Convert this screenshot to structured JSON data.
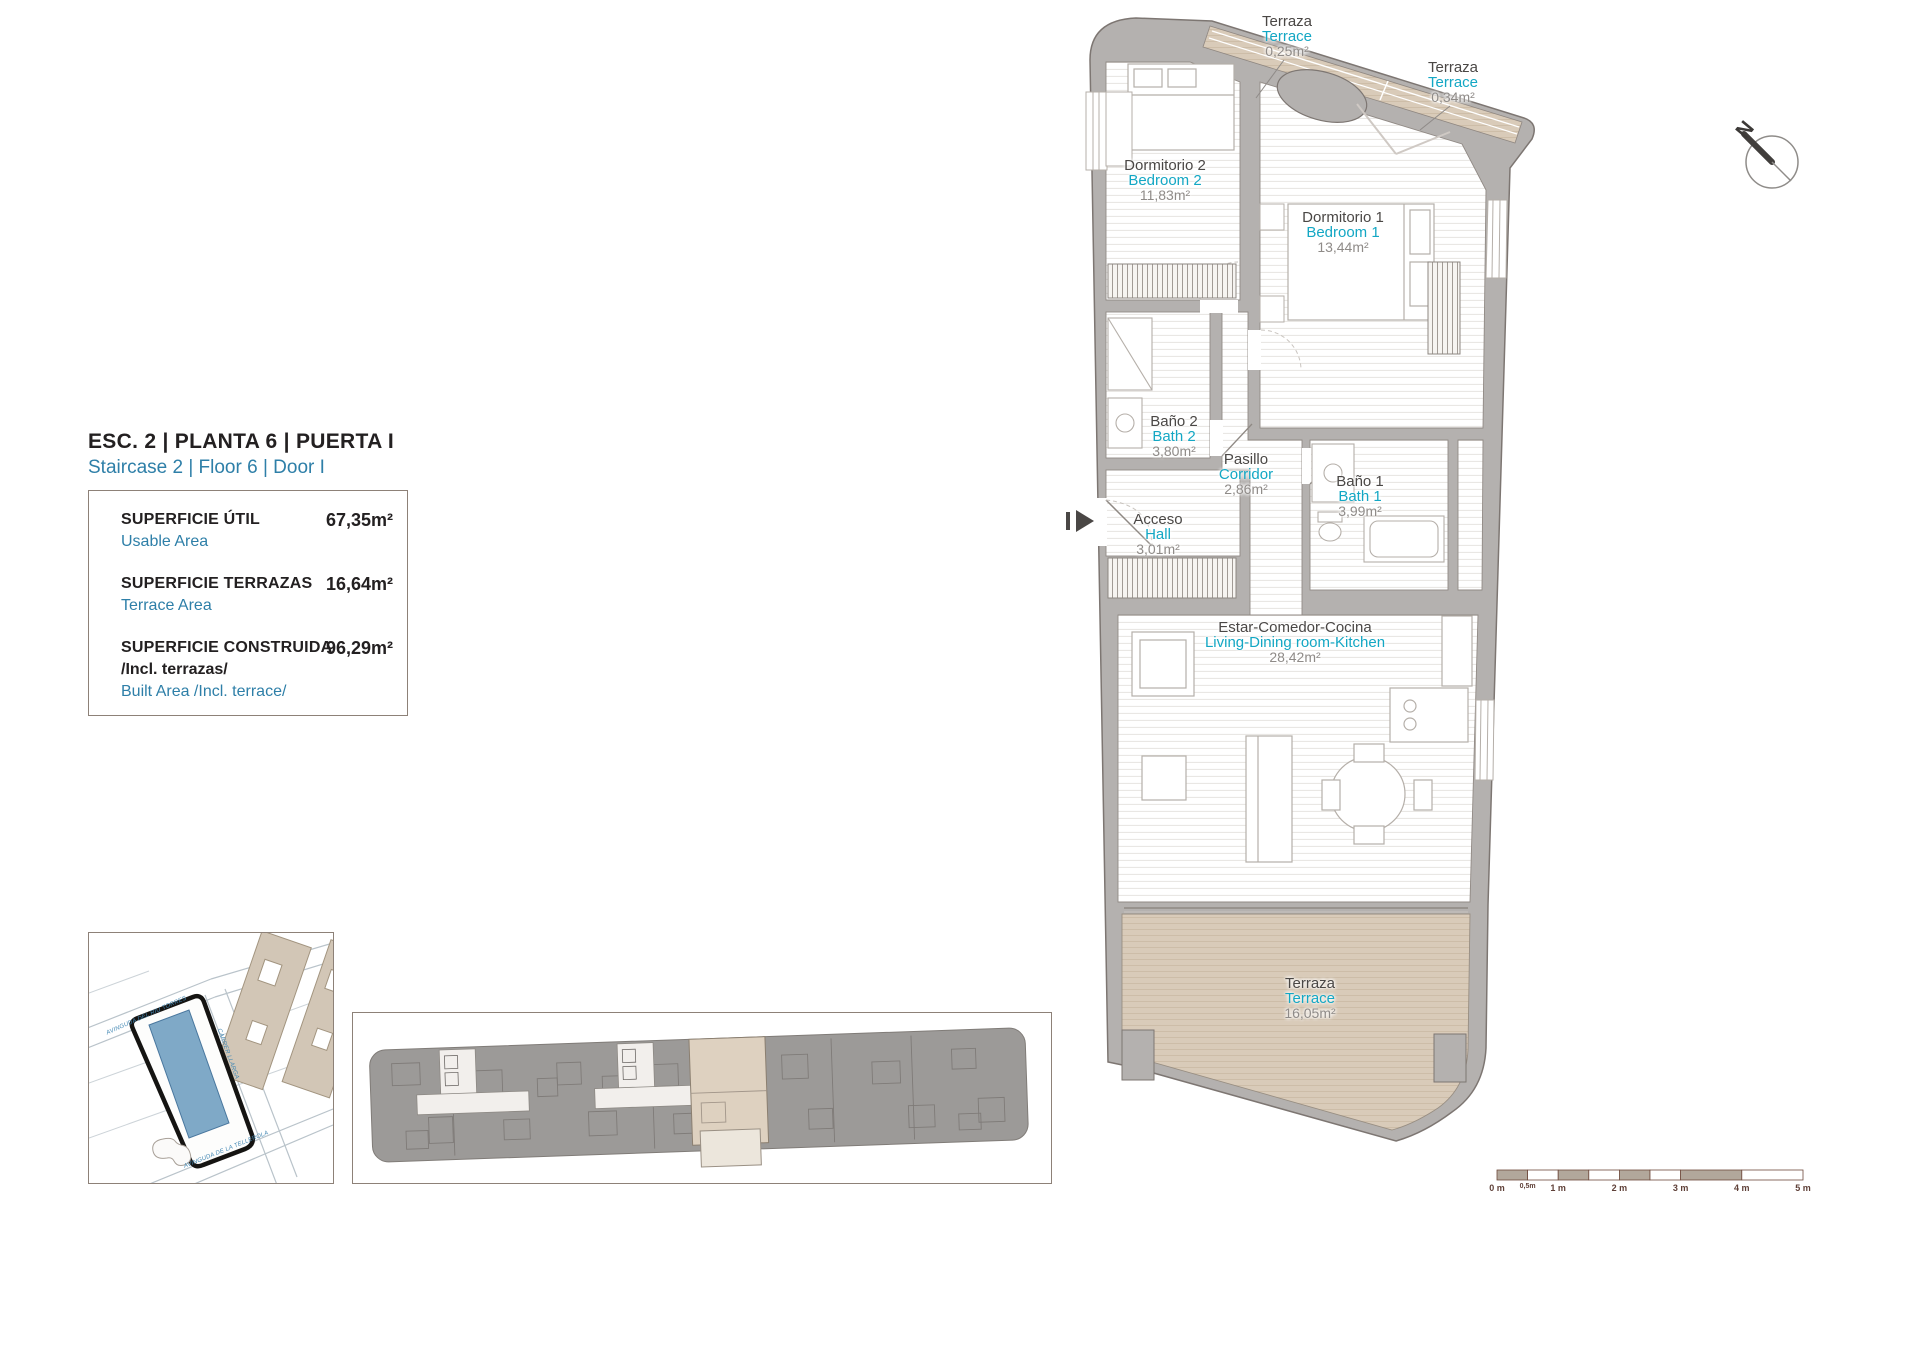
{
  "title": {
    "line_es": "ESC. 2 | PLANTA 6 | PUERTA I",
    "line_en": "Staircase 2 | Floor 6 | Door I"
  },
  "area_summary": {
    "usable": {
      "label_es": "SUPERFICIE ÚTIL",
      "label_en": "Usable Area",
      "value": "67,35m²"
    },
    "terrace": {
      "label_es": "SUPERFICIE TERRAZAS",
      "label_en": "Terrace Area",
      "value": "16,64m²"
    },
    "built": {
      "label_es": "SUPERFICIE CONSTRUIDA",
      "label_es_note": "/Incl. terrazas/",
      "label_en": "Built Area /Incl. terrace/",
      "value": "96,29m²"
    }
  },
  "rooms": {
    "terrace_top": {
      "es": "Terraza",
      "en": "Terrace",
      "area": "0,25m²"
    },
    "terrace_side": {
      "es": "Terraza",
      "en": "Terrace",
      "area": "0,34m²"
    },
    "bedroom2": {
      "es": "Dormitorio 2",
      "en": "Bedroom 2",
      "area": "11,83m²"
    },
    "bedroom1": {
      "es": "Dormitorio 1",
      "en": "Bedroom 1",
      "area": "13,44m²"
    },
    "bath2": {
      "es": "Baño 2",
      "en": "Bath 2",
      "area": "3,80m²"
    },
    "corridor": {
      "es": "Pasillo",
      "en": "Corridor",
      "area": "2,86m²"
    },
    "bath1": {
      "es": "Baño 1",
      "en": "Bath 1",
      "area": "3,99m²"
    },
    "hall": {
      "es": "Acceso",
      "en": "Hall",
      "area": "3,01m²"
    },
    "living": {
      "es": "Estar-Comedor-Cocina",
      "en": "Living-Dining room-Kitchen",
      "area": "28,42m²"
    },
    "terrace_main": {
      "es": "Terraza",
      "en": "Terrace",
      "area": "16,05m²"
    }
  },
  "compass": {
    "north_label": "N"
  },
  "scale_bar": {
    "labels": [
      "0 m",
      "0,5m",
      "1 m",
      "2 m",
      "3 m",
      "4 m",
      "5 m"
    ]
  },
  "site_map": {
    "streets": [
      "AVINGUDA DEL RIU TORRES",
      "CARRER LLARGA",
      "AVINGUDA DE LA TELLEROLA"
    ]
  },
  "colors": {
    "accent_blue": "#2e7fa8",
    "cyan_label": "#13a7c4",
    "terrace_beige": "#d9cbb9",
    "wall_gray": "#b4b1af",
    "site_building_blue": "#7fa9c7"
  }
}
